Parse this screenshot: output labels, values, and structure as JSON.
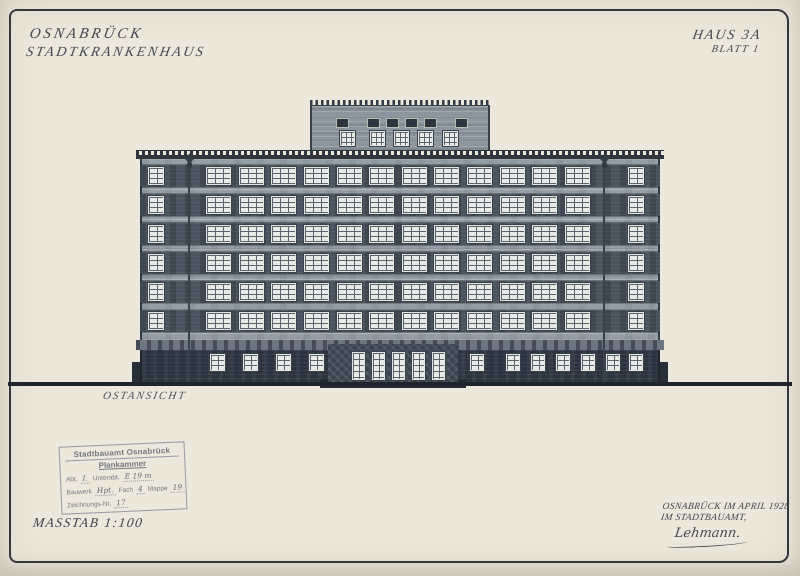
{
  "sheet": {
    "title_line1": "OSNABRÜCK",
    "title_line2": "STADTKRANKENHAUS",
    "ref_line1": "HAUS 3A",
    "ref_line2": "BLATT 1",
    "view_label": "OSTANSICHT",
    "scale_label": "MASSTAB 1:100",
    "date_line1": "OSNABRÜCK IM APRIL 1928",
    "date_line2": "IM STADTBAUAMT,",
    "signature": "Lehmann."
  },
  "stamp": {
    "office": "Stadtbauamt Osnabrück",
    "room": "Plankammer",
    "abt_label": "Abt.",
    "abt_value": "I.",
    "unterabt_label": "Unterabt.",
    "unterabt_value": "E 19 m",
    "bauwerk_label": "Bauwerk",
    "bauwerk_value": "Hpt.",
    "fach_label": "Fach",
    "fach_value": "4",
    "mappe_label": "Mappe",
    "mappe_value": "19",
    "zeichnung_label": "Zeichnungs-Nr.",
    "zeichnung_value": "17"
  },
  "building": {
    "view": "OSTANSICHT",
    "upper_floors": 6,
    "regular_windows_per_floor": 12,
    "narrow_end_windows_per_floor": 2,
    "penthouse_upper_windows": 6,
    "penthouse_lower_windows": 5,
    "entrance_doors": 5,
    "ground_left_windows": 4,
    "ground_right_windows": 7,
    "lamp_ornaments": 2
  },
  "colors": {
    "paper": "#ece8dc",
    "ink": "#2f353d",
    "facade_light": "#949ea7",
    "facade_dark_band": "#4a545f",
    "ground_floor": "#2b343f",
    "window_pane": "#e8eae6",
    "stamp_ink": "#6c7079"
  }
}
